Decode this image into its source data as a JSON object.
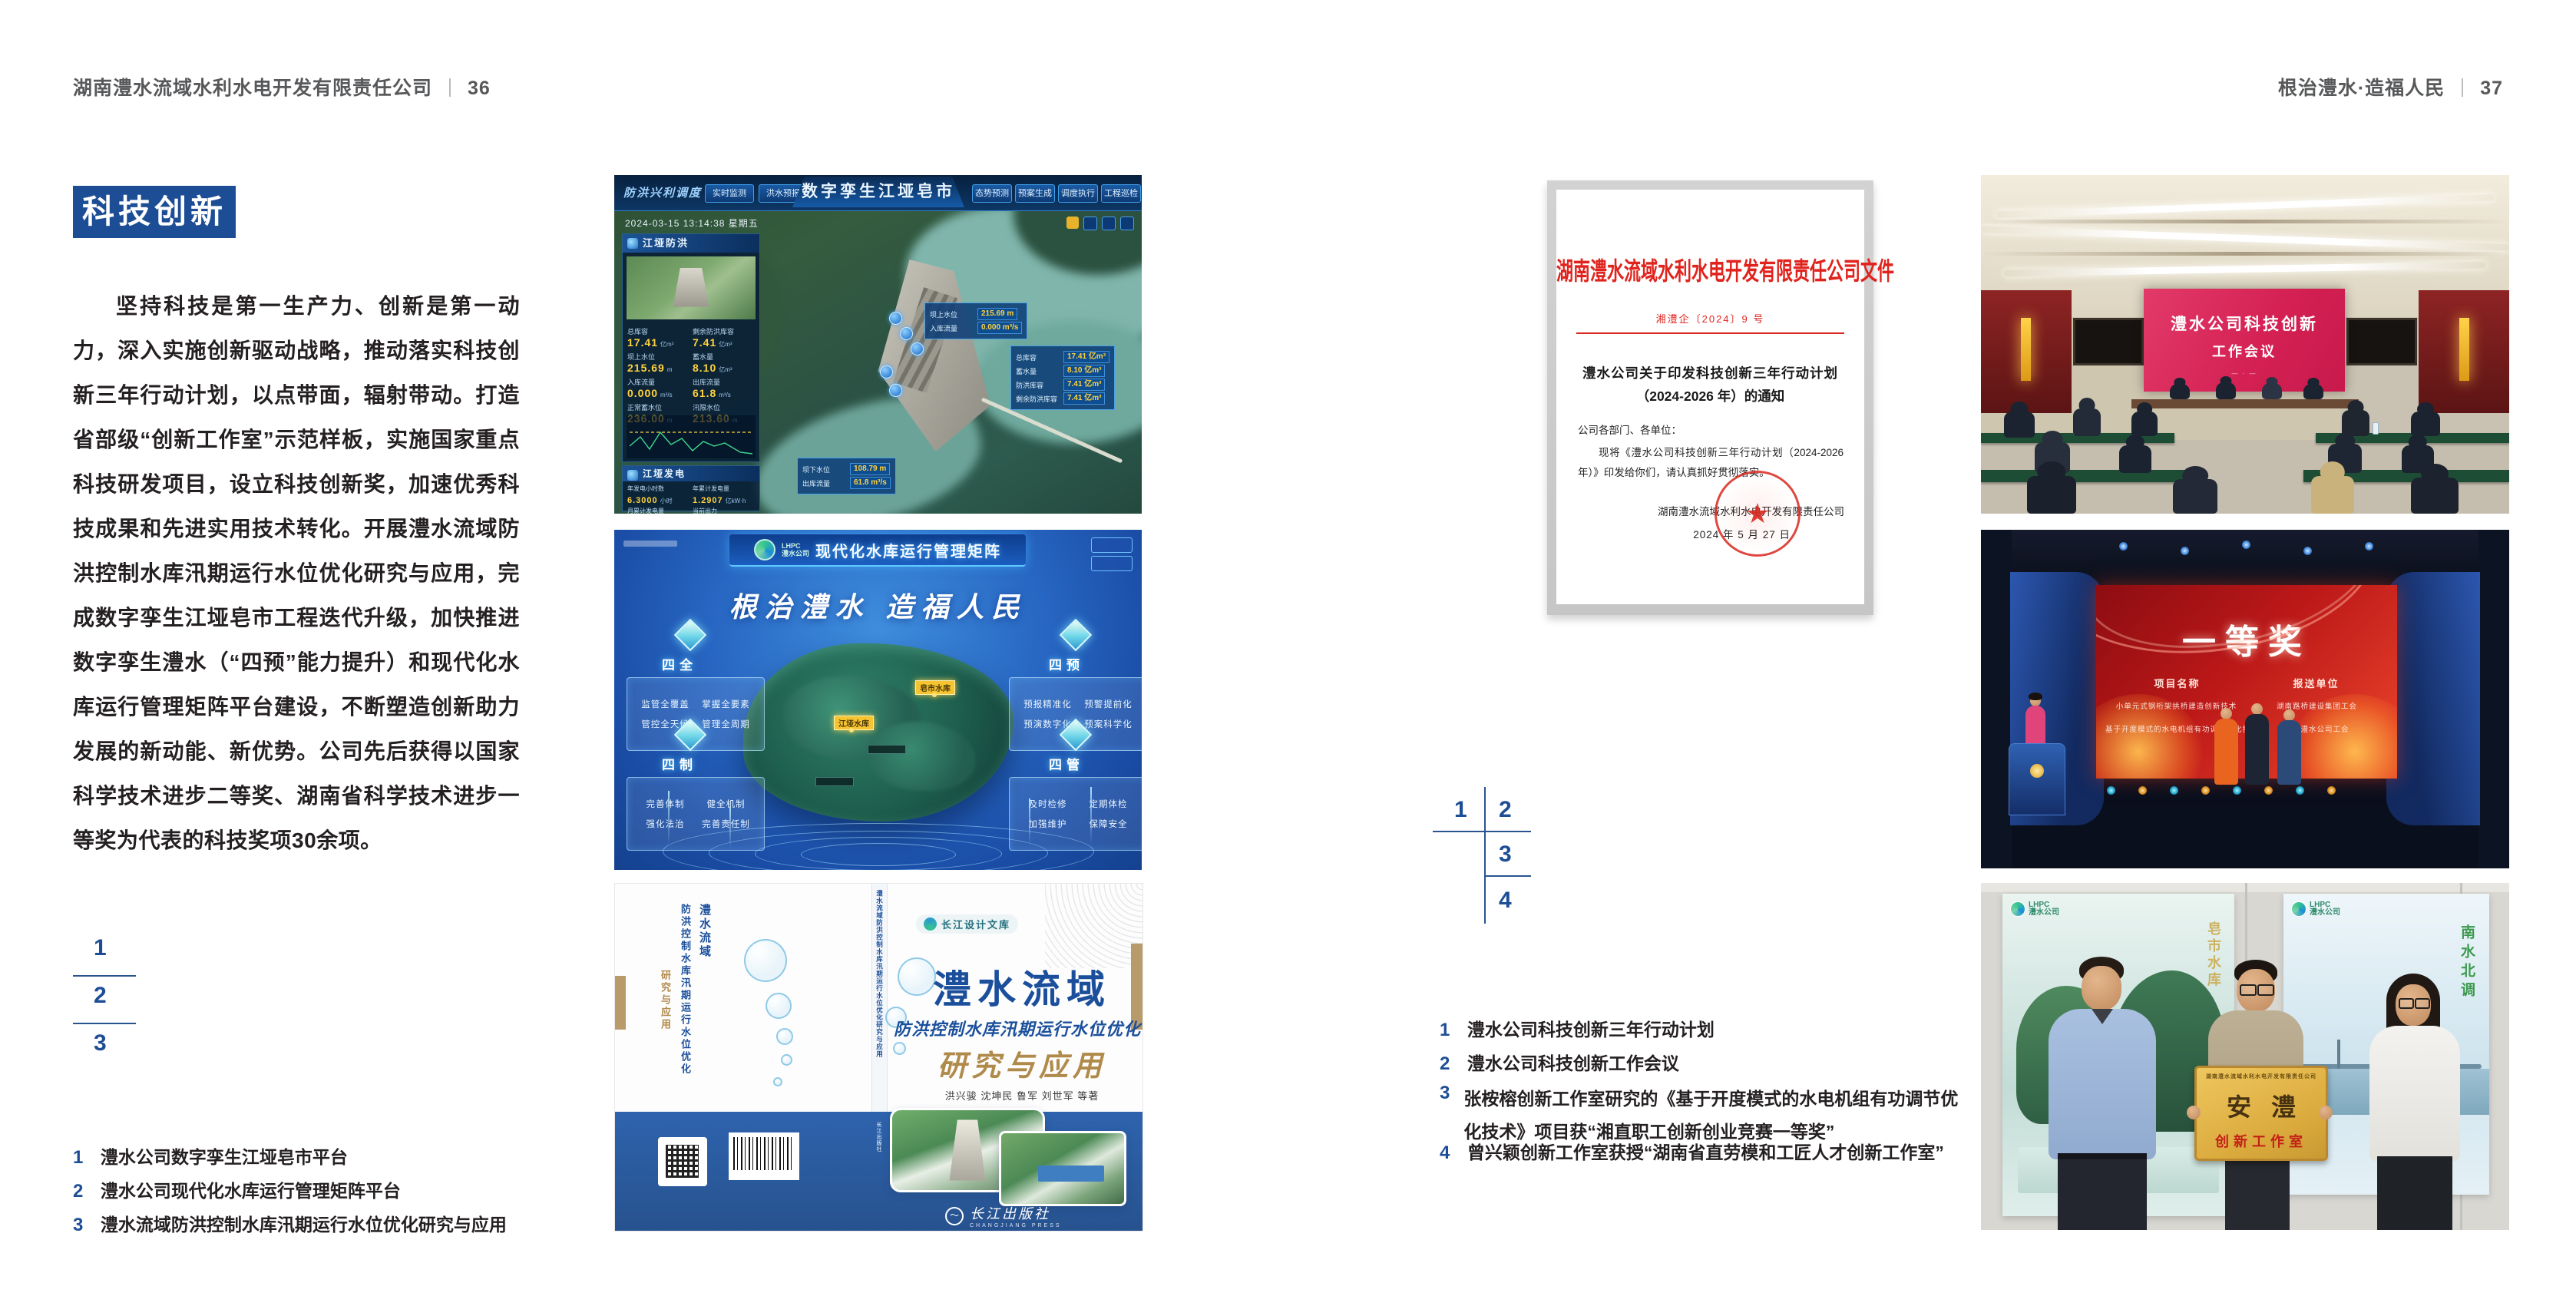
{
  "header": {
    "left_title": "湖南澧水流域水利水电开发有限责任公司",
    "left_page_no": "36",
    "right_title": "根治澧水·造福人民",
    "right_page_no": "37"
  },
  "left_page": {
    "badge": "科技创新",
    "paragraph": "坚持科技是第一生产力、创新是第一动力，深入实施创新驱动战略，推动落实科技创新三年行动计划，以点带面，辐射带动。打造省部级“创新工作室”示范样板，实施国家重点科技研发项目，设立科技创新奖，加速优秀科技成果和先进实用技术转化。开展澧水流域防洪控制水库汛期运行水位优化研究与应用，完成数字孪生江垭皂市工程迭代升级，加快推进数字孪生澧水（“四预”能力提升）和现代化水库运行管理矩阵平台建设，不断塑造创新助力发展的新动能、新优势。公司先后获得以国家科学技术进步二等奖、湖南省科学技术进步一等奖为代表的科技奖项30余项。",
    "keys": [
      "1",
      "2",
      "3"
    ],
    "captions": [
      {
        "num": "1",
        "text": "澧水公司数字孪生江垭皂市平台"
      },
      {
        "num": "2",
        "text": "澧水公司现代化水库运行管理矩阵平台"
      },
      {
        "num": "3",
        "text": "澧水流域防洪控制水库汛期运行水位优化研究与应用"
      }
    ]
  },
  "dashboard": {
    "brand": "防洪兴利调度",
    "title": "数字孪生江垭皂市",
    "tabs_left": [
      "实时监测",
      "洪水预报",
      "防洪预警"
    ],
    "tabs_right": [
      "态势预测",
      "预案生成",
      "调度执行",
      "工程巡检"
    ],
    "timestamp": "2024-03-15 13:14:38 星期五",
    "panel1": {
      "title": "江垭防洪",
      "stats": [
        [
          "总库容",
          "17.41",
          "亿m³"
        ],
        [
          "剩余防洪库容",
          "7.41",
          "亿m³"
        ],
        [
          "坝上水位",
          "215.69",
          "m"
        ],
        [
          "蓄水量",
          "8.10",
          "亿m³"
        ],
        [
          "入库流量",
          "0.000",
          "m³/s"
        ],
        [
          "出库流量",
          "61.8",
          "m³/s"
        ],
        [
          "正常蓄水位",
          "236.00",
          "m"
        ],
        [
          "汛限水位",
          "213.60",
          "m"
        ]
      ]
    },
    "panel2": {
      "title": "江垭发电",
      "stats": [
        [
          "年发电小时数",
          "6.3000",
          "小时"
        ],
        [
          "年累计发电量",
          "1.2907",
          "亿kW·h"
        ],
        [
          "月累计发电量",
          "3359.21",
          "万kW·h"
        ],
        [
          "当前出力",
          "0.00",
          "MW"
        ]
      ]
    },
    "tip1": [
      [
        "坝上水位",
        "215.69 m"
      ],
      [
        "入库流量",
        "0.000 m³/s"
      ]
    ],
    "tip2": [
      [
        "总库容",
        "17.41 亿m³"
      ],
      [
        "蓄水量",
        "8.10 亿m³"
      ],
      [
        "防洪库容",
        "7.41 亿m³"
      ],
      [
        "剩余防洪库容",
        "7.41 亿m³"
      ]
    ],
    "tip3": [
      [
        "坝下水位",
        "108.79 m"
      ],
      [
        "出库流量",
        "61.8 m³/s"
      ]
    ]
  },
  "matrix": {
    "logo": "LHPC",
    "logo_sub": "澧水公司",
    "title": "现代化水库运行管理矩阵",
    "slogan": "根治澧水 造福人民",
    "marker1": "江垭水库",
    "marker2": "皂市水库",
    "groups": [
      {
        "name": "四全",
        "items": [
          "监管全覆盖",
          "掌握全要素",
          "管控全天候",
          "管理全周期"
        ]
      },
      {
        "name": "四预",
        "items": [
          "预报精准化",
          "预警提前化",
          "预演数字化",
          "预案科学化"
        ]
      },
      {
        "name": "四制",
        "items": [
          "完善体制",
          "健全机制",
          "强化法治",
          "完善责任制"
        ]
      },
      {
        "name": "四管",
        "items": [
          "及时检修",
          "定期体检",
          "加强维护",
          "保障安全"
        ]
      }
    ]
  },
  "book": {
    "series": "长江设计文库",
    "title": "澧水流域",
    "subtitle": "防洪控制水库汛期运行水位优化",
    "title2": "研究与应用",
    "authors": "洪兴骏  沈坤民  鲁军  刘世军  等著",
    "publisher": "长江出版社",
    "publisher_en": "CHANGJIANG PRESS",
    "spine": "澧水流域防洪控制水库汛期运行水位优化研究与应用"
  },
  "document": {
    "header": "湖南澧水流域水利水电开发有限责任公司文件",
    "doc_no": "湘澧企〔2024〕9 号",
    "title_line1": "澧水公司关于印发科技创新三年行动计划",
    "title_line2": "（2024-2026 年）的通知",
    "salutation": "公司各部门、各单位：",
    "body": "现将《澧水公司科技创新三年行动计划（2024-2026 年）》印发给你们，请认真抓好贯彻落实。",
    "signer": "湖南澧水流域水利水电开发有限责任公司",
    "date": "2024 年 5 月 27 日"
  },
  "right_page": {
    "keys": [
      "1",
      "2",
      "3",
      "4"
    ],
    "captions": [
      {
        "num": "1",
        "text": "澧水公司科技创新三年行动计划"
      },
      {
        "num": "2",
        "text": "澧水公司科技创新工作会议"
      },
      {
        "num": "3",
        "text": "张桉榕创新工作室研究的《基于开度模式的水电机组有功调节优化技术》项目获“湘直职工创新创业竞赛一等奖”"
      },
      {
        "num": "4",
        "text": "曾兴颖创新工作室获授“湖南省直劳模和工匠人才创新工作室”"
      }
    ]
  },
  "meeting": {
    "screen_line1": "澧水公司科技创新",
    "screen_line2": "工作会议"
  },
  "award": {
    "prize": "一等奖",
    "col1_header": "项目名称",
    "col2_header": "报送单位",
    "col1_rows": [
      "小单元式钢桁架拱桥建造创新技术",
      "基于开度模式的水电机组有功调节优化技术"
    ],
    "col2_rows": [
      "湖南路桥建设集团工会",
      "湖南澧水公司工会"
    ]
  },
  "plaque": {
    "org": "湖南澧水流域水利水电开发有限责任公司",
    "name": "安澧",
    "sub": "创新工作室",
    "poster_left_logo": "LHPC",
    "poster_right_logo": "LHPC",
    "logo_sub": "澧水公司",
    "poster_right_vertical": "南水北调"
  },
  "colors": {
    "accent": "#1d4e95",
    "doc_red": "#e0231d"
  }
}
